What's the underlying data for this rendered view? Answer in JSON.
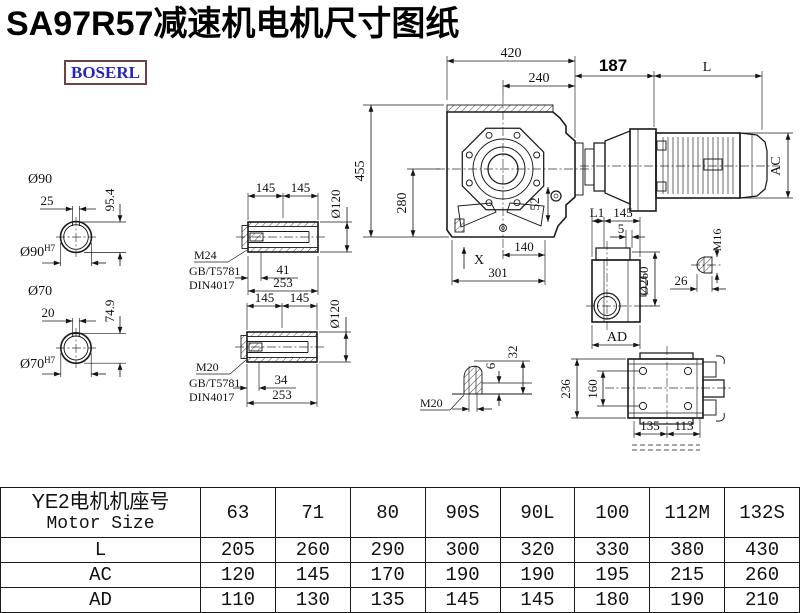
{
  "title": "SA97R57减速机电机尺寸图纸",
  "logo": "BOSERL",
  "dims": {
    "shaft_upper": {
      "dia": "Ø90",
      "key_w": "25",
      "depth": "95.4",
      "bore": "Ø90",
      "tol": "H7"
    },
    "shaft_lower": {
      "dia": "Ø70",
      "key_w": "20",
      "depth": "74.9",
      "bore": "Ø70",
      "tol": "H7"
    },
    "hollow_upper": {
      "l1": "145",
      "l2": "145",
      "dia": "Ø120",
      "thread": "M24",
      "std1": "GB/T5781",
      "std2": "DIN4017",
      "t_depth": "41",
      "total": "253"
    },
    "hollow_lower": {
      "l1": "145",
      "l2": "145",
      "dia": "Ø120",
      "thread": "M20",
      "std1": "GB/T5781",
      "std2": "DIN4017",
      "t_depth": "34",
      "total": "253"
    },
    "front": {
      "w": "420",
      "w2": "240",
      "h": "455",
      "h2": "280",
      "d52": "52",
      "d140": "140",
      "d301": "301",
      "x": "X"
    },
    "motor": {
      "d187": "187",
      "L": "L",
      "AC": "AC"
    },
    "side": {
      "L1": "L1",
      "d145": "145",
      "d5": "5",
      "dia": "Ø260",
      "AD": "AD",
      "thread": "M16",
      "d26": "26"
    },
    "stud": {
      "thread": "M20",
      "d6": "6",
      "d32": "32"
    },
    "rear": {
      "d236": "236",
      "d160": "160",
      "d135": "135",
      "d113": "113"
    }
  },
  "table": {
    "header_cn": "YE2电机机座号",
    "header_en": "Motor Size",
    "columns": [
      "63",
      "71",
      "80",
      "90S",
      "90L",
      "100",
      "112M",
      "132S"
    ],
    "rows": [
      {
        "label": "L",
        "values": [
          "205",
          "260",
          "290",
          "300",
          "320",
          "330",
          "380",
          "430"
        ]
      },
      {
        "label": "AC",
        "values": [
          "120",
          "145",
          "170",
          "190",
          "190",
          "195",
          "215",
          "260"
        ]
      },
      {
        "label": "AD",
        "values": [
          "110",
          "130",
          "135",
          "145",
          "145",
          "180",
          "190",
          "210"
        ]
      }
    ]
  }
}
